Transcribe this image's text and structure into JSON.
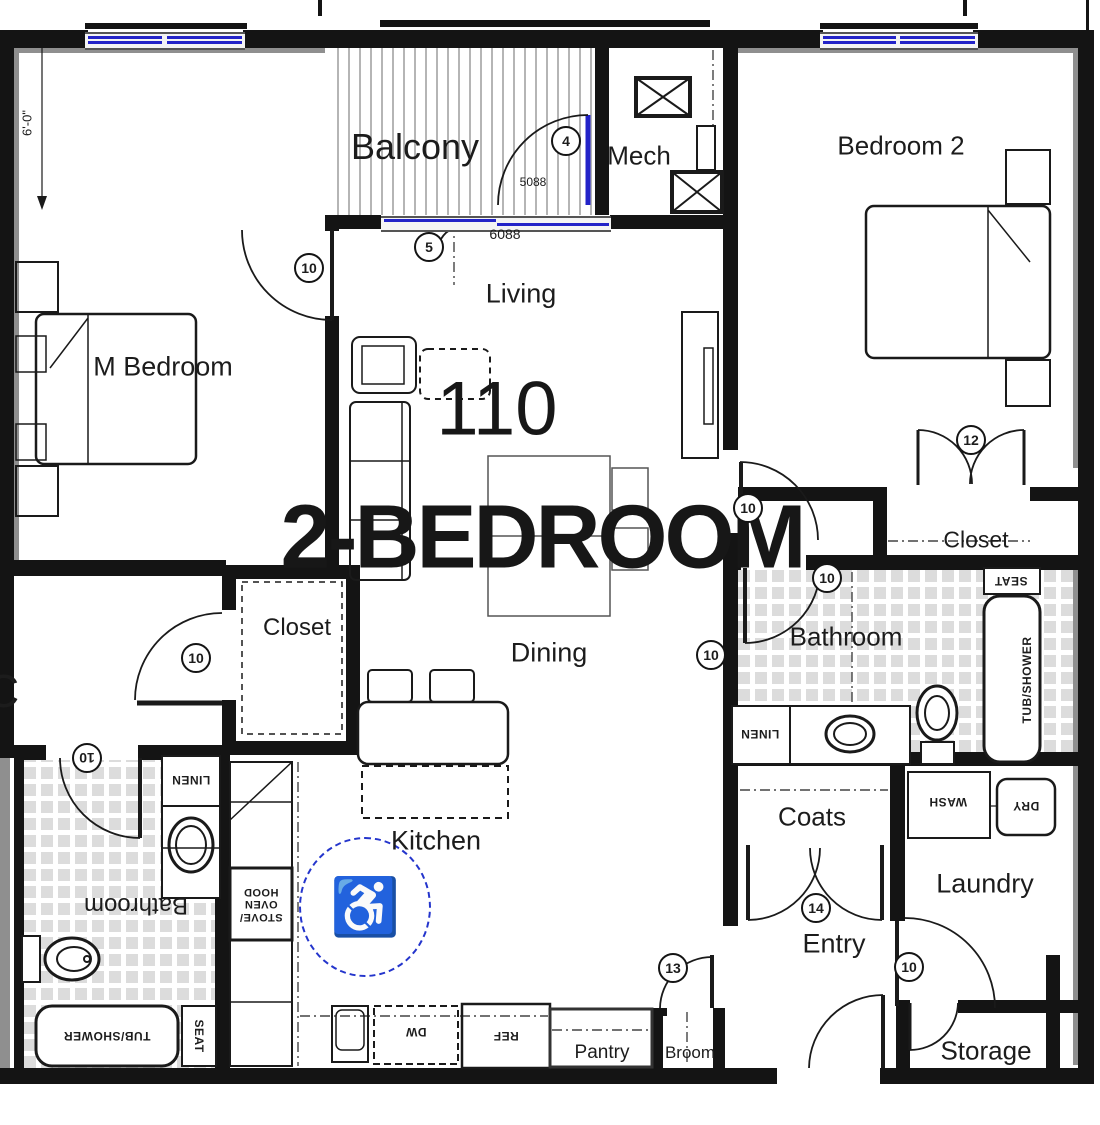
{
  "unit": {
    "number": "110",
    "type_label": "2-BEDROOM"
  },
  "rooms": {
    "balcony": "Balcony",
    "mech": "Mech",
    "bedroom2": "Bedroom 2",
    "master_bedroom": "M Bedroom",
    "living": "Living",
    "dining": "Dining",
    "kitchen": "Kitchen",
    "bathroom": "Bathroom",
    "bathroom2": "Bathroom",
    "closet_master": "Closet",
    "closet_bedroom2": "Closet",
    "coats": "Coats",
    "laundry": "Laundry",
    "entry": "Entry",
    "storage": "Storage",
    "pantry": "Pantry",
    "broom": "Broom",
    "neighbor_label_partial": "C"
  },
  "dimensions": {
    "balcony_depth": "6'-0\"",
    "balcony_door": "5088",
    "balcony_opening": "6088"
  },
  "door_tags": {
    "t4": "4",
    "t5": "5",
    "t10": "10",
    "t12": "12",
    "t13": "13",
    "t14": "14"
  },
  "fixtures": {
    "linen": "LINEN",
    "tub_shower": "TUB/SHOWER",
    "seat": "SEAT",
    "wash": "WASH",
    "dry": "DRY",
    "fridge": "REF",
    "dishwasher": "DW",
    "range": "STOVE/\nOVEN\nHOOD"
  },
  "icons": {
    "accessible_symbol": "♿"
  },
  "colors": {
    "wall": "#141414",
    "window_blue": "#2323c8",
    "accessible_blue": "#2435cc",
    "tile_gray": "#dcdcdc"
  }
}
